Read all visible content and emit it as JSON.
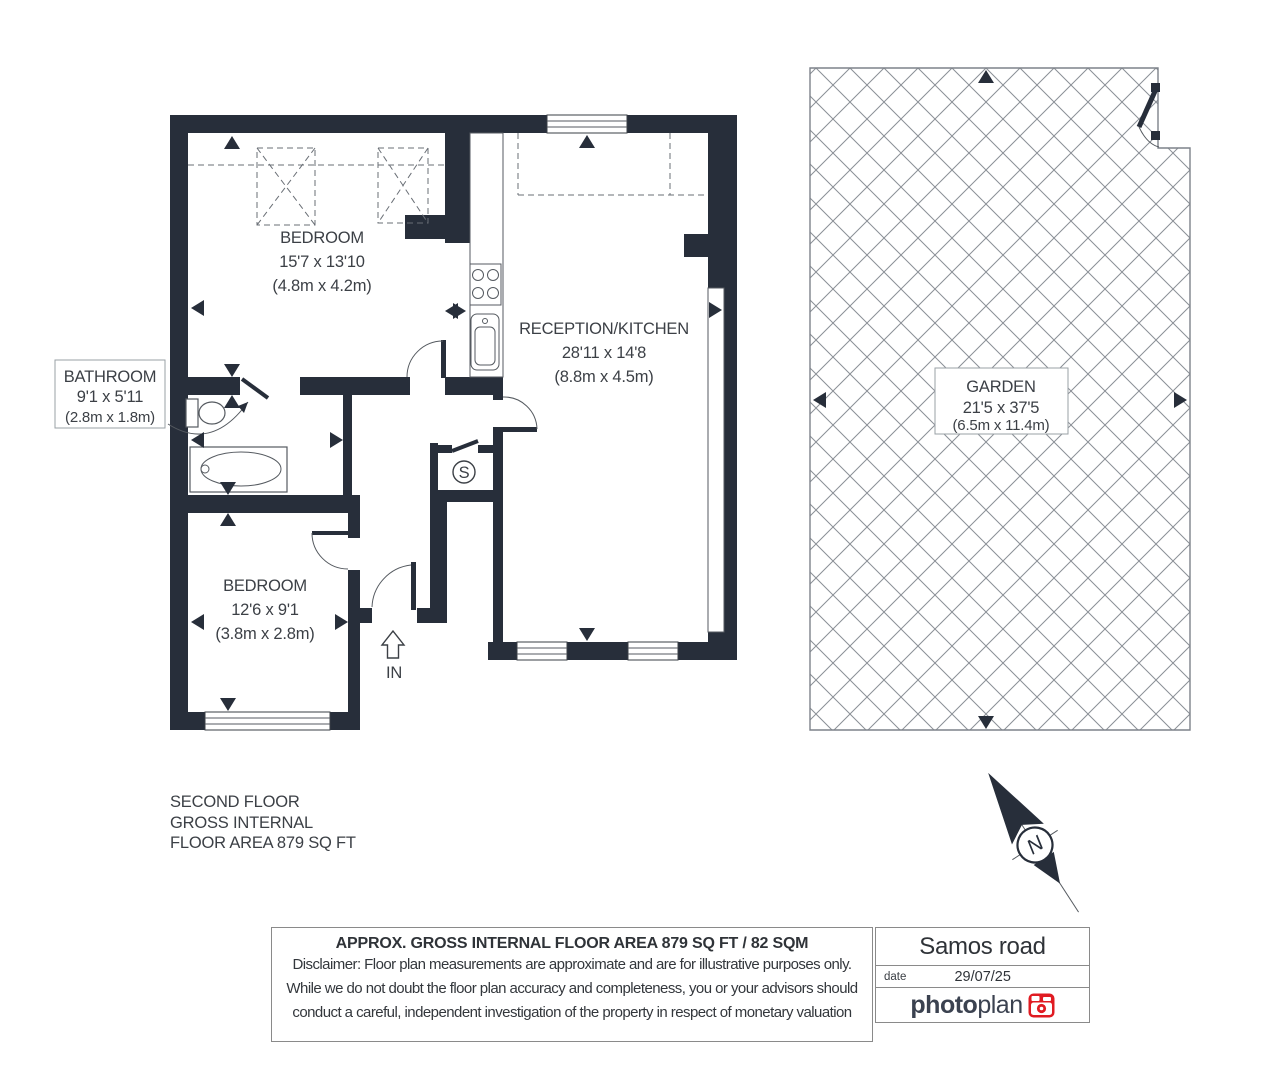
{
  "plan": {
    "bedroom1": {
      "name": "BEDROOM",
      "dims": "15'7 x 13'10",
      "metric": "(4.8m x 4.2m)"
    },
    "reception": {
      "name": "RECEPTION/KITCHEN",
      "dims": "28'11 x 14'8",
      "metric": "(8.8m x 4.5m)"
    },
    "bathroom": {
      "name": "BATHROOM",
      "dims": "9'1 x 5'11",
      "metric": "(2.8m x 1.8m)"
    },
    "bedroom2": {
      "name": "BEDROOM",
      "dims": "12'6 x 9'1",
      "metric": "(3.8m x 2.8m)"
    },
    "garden": {
      "name": "GARDEN",
      "dims": "21'5 x 37'5",
      "metric": "(6.5m x 11.4m)"
    },
    "storage_label": "S",
    "entrance_label": "IN",
    "compass_label": "N"
  },
  "floor_summary": {
    "line1": "SECOND FLOOR",
    "line2": "GROSS INTERNAL",
    "line3": "FLOOR AREA 879 SQ FT"
  },
  "footer": {
    "title": "APPROX. GROSS INTERNAL FLOOR AREA 879 SQ FT / 82 SQM",
    "disclaimer_line1": "Disclaimer: Floor plan measurements are approximate and are for illustrative purposes only.",
    "disclaimer_line2": "While we do not doubt the floor plan accuracy and completeness, you or your advisors should",
    "disclaimer_line3": "conduct a careful, independent investigation of the property in respect of monetary valuation",
    "address": "Samos road",
    "date_label": "date",
    "date_value": "29/07/25",
    "brand_bold": "photo",
    "brand_light": "plan"
  },
  "colors": {
    "wall": "#272e3a",
    "thin_line": "#555a60",
    "text": "#3c4046",
    "brand_red": "#e01b22",
    "lattice": "#8a8f96"
  }
}
